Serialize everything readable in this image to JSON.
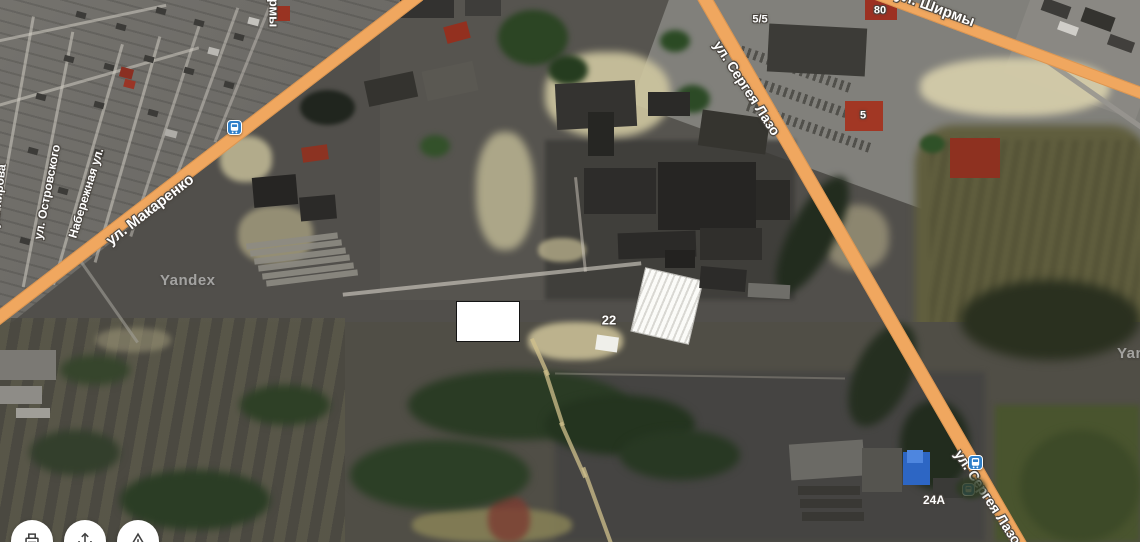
{
  "map": {
    "provider": "Yandex",
    "watermark": "Yandex",
    "roads": {
      "makarenko": "ул. Макаренко",
      "lazo_top": "ул. Сергея Лазо",
      "lazo_bottom": "ул. Сергея Лазо",
      "shirmy": "ул. Ширмы",
      "rmy_partial": "рмы",
      "ostrovskogo": "ул. Островского",
      "naberezhnaya": "Набережная ул.",
      "kirova": "ул. Кирова"
    },
    "house_numbers": {
      "n5_5": "5/5",
      "n80": "80",
      "n5": "5",
      "n22": "22",
      "n24a": "24А"
    },
    "icons": {
      "bus_stop": "bus-stop-icon",
      "print": "printer-icon",
      "share": "share-icon",
      "report": "warning-triangle-icon"
    },
    "colors": {
      "road_orange": "#f0a75f",
      "bus_stop_blue": "#2f7fc9",
      "label_text": "#ffffff"
    }
  }
}
